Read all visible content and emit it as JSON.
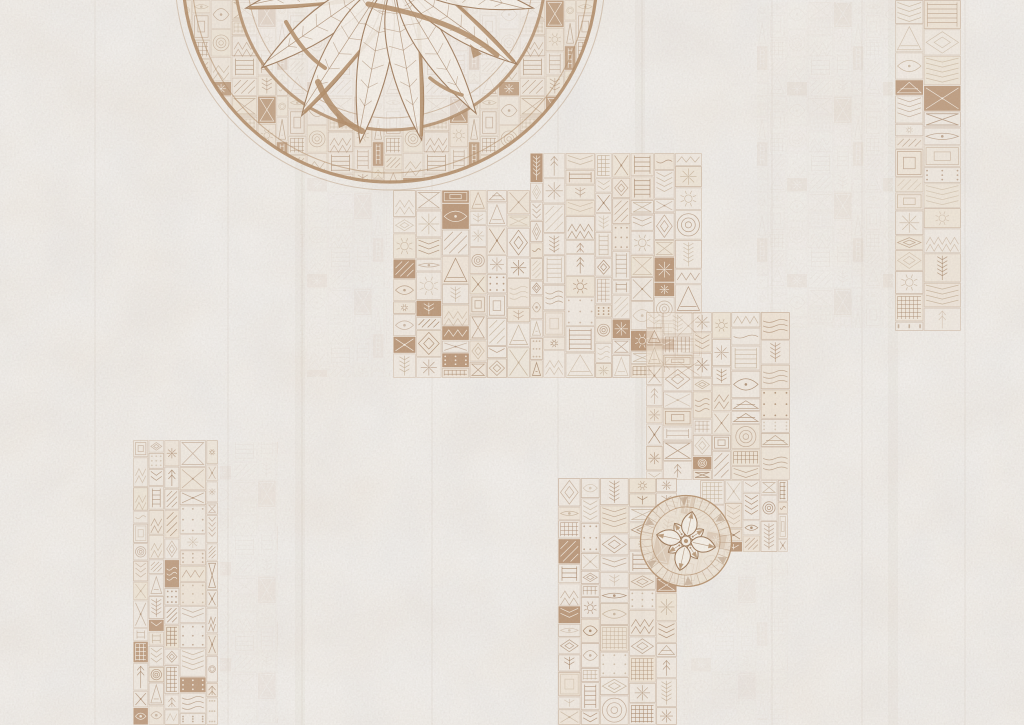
{
  "artwork": {
    "kind": "decorative-aged-plaster-wallpaper",
    "description": "Off-white weathered plaster wall covered with sepia hand-drawn ethnic doodle tile patches, a large partially cropped mandala medallion with feathered leaves at the top center, and a small eight-petal flower medallion among the lower patches",
    "canvas": {
      "width": 1024,
      "height": 725
    },
    "palette": {
      "base": "#f0ede9",
      "patch_base": "#efe6d9",
      "ink": "#9d7a5b",
      "ink_mid": "#a8876a",
      "ink_faint": "#bfa98f",
      "tile_light": "#ecdfcc",
      "cream": "#f4efe7",
      "solid_tile": "#b08a68",
      "white_ink": "#f7f2ea",
      "ring": "#b08c68",
      "seam": "#b6a490",
      "band_under": "#e9ddca",
      "small_mandala_base": "#ece2d4"
    },
    "motifs": [
      "x-cross",
      "diagonal-stripes",
      "chevron-column",
      "triangle",
      "concentric-circles",
      "dot-grid",
      "zigzag",
      "starburst",
      "diamond",
      "arrow-up",
      "ladder",
      "waves",
      "sun",
      "cross-hatch",
      "square-rings",
      "hourglass",
      "feather-branch",
      "eye"
    ],
    "patches": [
      {
        "name": "central-upper-left",
        "x": 393,
        "y": 190,
        "w": 137,
        "h": 188
      },
      {
        "name": "central-upper-right",
        "x": 530,
        "y": 153,
        "w": 172,
        "h": 225
      },
      {
        "name": "central-mid-right",
        "x": 646,
        "y": 312,
        "w": 144,
        "h": 168
      },
      {
        "name": "mid-right-lower-arm",
        "x": 700,
        "y": 480,
        "w": 88,
        "h": 72
      },
      {
        "name": "bottom-column",
        "x": 558,
        "y": 478,
        "w": 119,
        "h": 247
      },
      {
        "name": "left-strip",
        "x": 133,
        "y": 440,
        "w": 85,
        "h": 285
      },
      {
        "name": "right-strip",
        "x": 895,
        "y": 0,
        "w": 66,
        "h": 331
      }
    ],
    "ghost_patches": [
      {
        "name": "ghost-right-of-mandala",
        "x": 757,
        "y": 2,
        "w": 136,
        "h": 326,
        "opacity": 0.1
      },
      {
        "name": "ghost-below-mandala",
        "x": 300,
        "y": 155,
        "w": 90,
        "h": 222,
        "opacity": 0.08
      },
      {
        "name": "ghost-right-of-left-strip",
        "x": 220,
        "y": 442,
        "w": 58,
        "h": 281,
        "opacity": 0.08
      },
      {
        "name": "ghost-below-small-mandala",
        "x": 683,
        "y": 560,
        "w": 105,
        "h": 160,
        "opacity": 0.06
      }
    ],
    "seams": {
      "lines": [
        95,
        228,
        302,
        432,
        558,
        642,
        772,
        862,
        965
      ],
      "bands": [
        300,
        640,
        893
      ]
    },
    "large_mandala": {
      "cx": 390,
      "cy": -25,
      "rings": [
        {
          "r": 143,
          "sw": 1,
          "o": 0.5
        },
        {
          "r": 155,
          "sw": 3,
          "o": 0.85
        },
        {
          "r": 198,
          "sw": 1.1,
          "o": 0.55
        },
        {
          "r": 207,
          "sw": 3.2,
          "o": 0.9
        },
        {
          "r": 215,
          "sw": 1,
          "o": 0.4
        }
      ],
      "band": {
        "inner": 155,
        "outer": 207
      },
      "leaves": [
        {
          "rot": 78,
          "len": 148,
          "hw": 19,
          "accent": true
        },
        {
          "rot": 55,
          "len": 158,
          "hw": 21,
          "accent": false
        },
        {
          "rot": 33,
          "len": 166,
          "hw": 22,
          "accent": true
        },
        {
          "rot": 11,
          "len": 170,
          "hw": 22,
          "accent": false
        },
        {
          "rot": -10,
          "len": 168,
          "hw": 22,
          "accent": true
        },
        {
          "rot": -31,
          "len": 163,
          "hw": 21,
          "accent": false
        },
        {
          "rot": -54,
          "len": 155,
          "hw": 20,
          "accent": true
        },
        {
          "rot": -76,
          "len": 147,
          "hw": 19,
          "accent": false
        }
      ],
      "crescents": [
        {
          "d": "M 368 4 C 425 14 468 30 497 55",
          "sw": 5
        },
        {
          "d": "M 286 22 C 298 44 310 58 325 68",
          "sw": 4
        },
        {
          "d": "M 318 82 C 328 106 342 122 362 131",
          "sw": 6
        },
        {
          "d": "M 430 78 C 441 87 451 92 462 95",
          "sw": 3.5
        }
      ],
      "solid_marks": [
        "336,112 348,124 339,128",
        "470,44 482,54 473,58"
      ]
    },
    "small_mandala": {
      "cx": 686,
      "cy": 541,
      "r": 46,
      "ring_inner": 34,
      "spokes": 36,
      "petal_len": 30,
      "petal_hw": 11,
      "small_len": 21,
      "small_hw": 7,
      "rot": 12
    },
    "texture": {
      "grain_opacity": 0.45,
      "blotch_opacity": 0.5,
      "blotch2_opacity": 0.4
    },
    "seed": 7
  }
}
